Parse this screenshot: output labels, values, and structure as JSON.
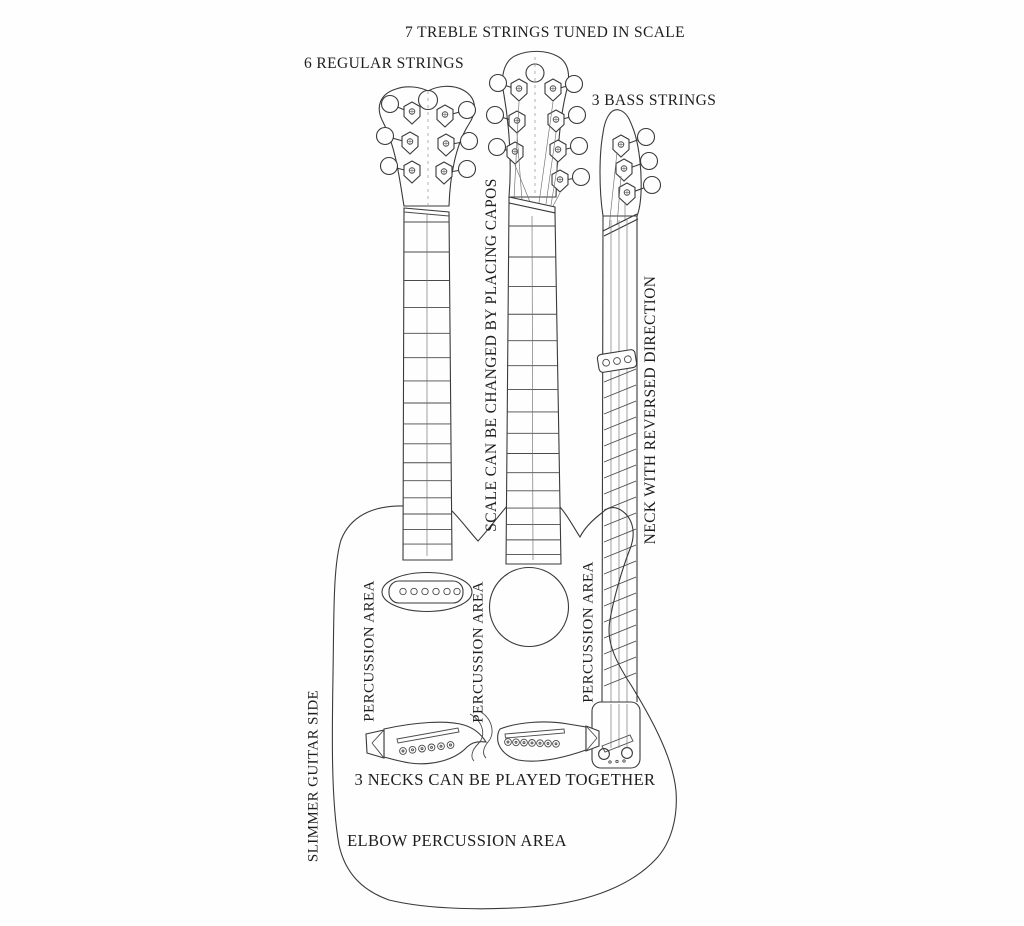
{
  "page": {
    "type": "scanned line-art diagram of a triple-neck acoustic guitar",
    "colors": {
      "ink": "#3a3a3a",
      "paper": "#fefefe",
      "text": "#1e1e1e"
    }
  },
  "labels": {
    "treble_strings": "7 TREBLE STRINGS TUNED IN SCALE",
    "regular_strings": "6 REGULAR STRINGS",
    "bass_strings": "3 BASS STRINGS",
    "capos": "SCALE CAN BE CHANGED BY PLACING CAPOS",
    "reversed_neck": "NECK WITH REVERSED DIRECTION",
    "percussion_area_left": "PERCUSSION AREA",
    "percussion_area_middle": "PERCUSSION AREA",
    "percussion_area_right": "PERCUSSION AREA",
    "slimmer_side": "SLIMMER GUITAR SIDE",
    "necks_together": "3 NECKS CAN BE PLAYED TOGETHER",
    "elbow_percussion": "ELBOW PERCUSSION AREA"
  }
}
